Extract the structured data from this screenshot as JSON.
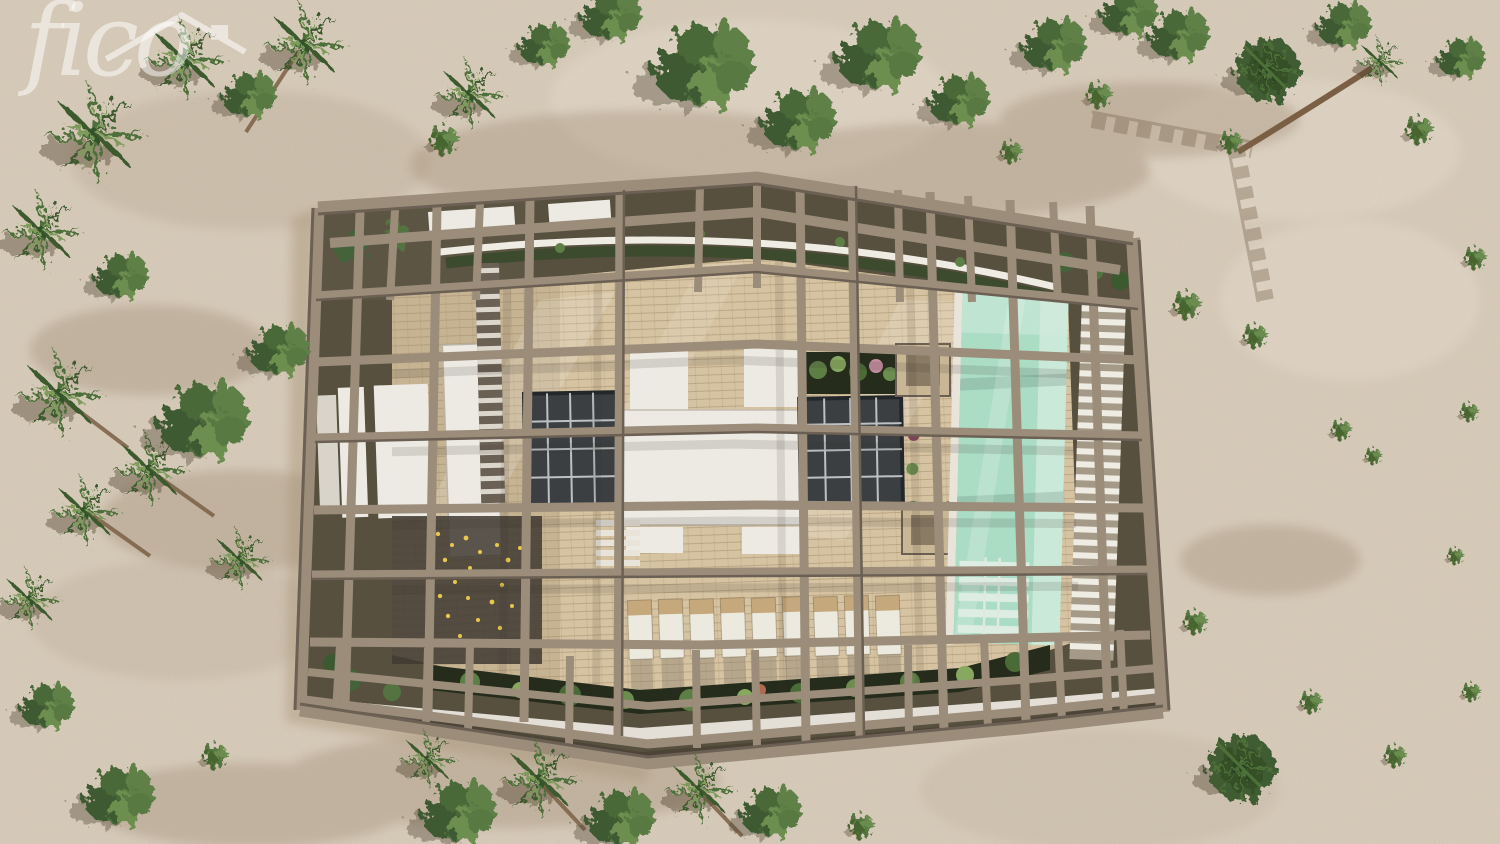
{
  "watermark": {
    "brand_text": "fico",
    "icon": "house-roof-icon"
  },
  "scene": {
    "title": "Aerial top-down 3D render of a modern beach villa",
    "environment": "Sandy plot with palm trees, round leafy trees and low shrubs",
    "building": {
      "pergola": "Tan structural beam grid (brise-soleil) covering the whole roof",
      "roof_terrace": "Cream stone-tiled roof terrace",
      "white_roof_volumes": 6,
      "skylights": 2,
      "pool": "Rectangular turquoise rooftop pool with internal stair at its south end",
      "sun_loungers_count": 9,
      "planted_borders": "Dark planting beds with tropical plants along north and south edges",
      "louvre_walkways": "White slatted louvre strips beside the pool and along the south edge"
    },
    "colors": {
      "sand": "#d6c9b7",
      "sand_light": "#e4dac9",
      "sand_shadow": "#b3a28c",
      "foliage_dark": "#3a512e",
      "foliage_mid": "#55753f",
      "foliage_light": "#7b9a58",
      "trunk": "#7a5f45",
      "beam": "#9b8d7a",
      "beam_dark": "#6b6053",
      "recess": "#57503f",
      "terrace": "#d6c3a1",
      "terrace_shadow": "#a28d71",
      "roof_white": "#edeae3",
      "glass_dark": "#3b3f42",
      "glass_mullion": "#ccd0d2",
      "pool": "#abdcc4",
      "pool_light": "#d3ecdd",
      "plant_bed": "#262c1c",
      "lounger_pad": "#eceade",
      "lounger_frame": "#c5a97c",
      "walk_white": "#efece4",
      "watermark": "#ffffff"
    }
  }
}
